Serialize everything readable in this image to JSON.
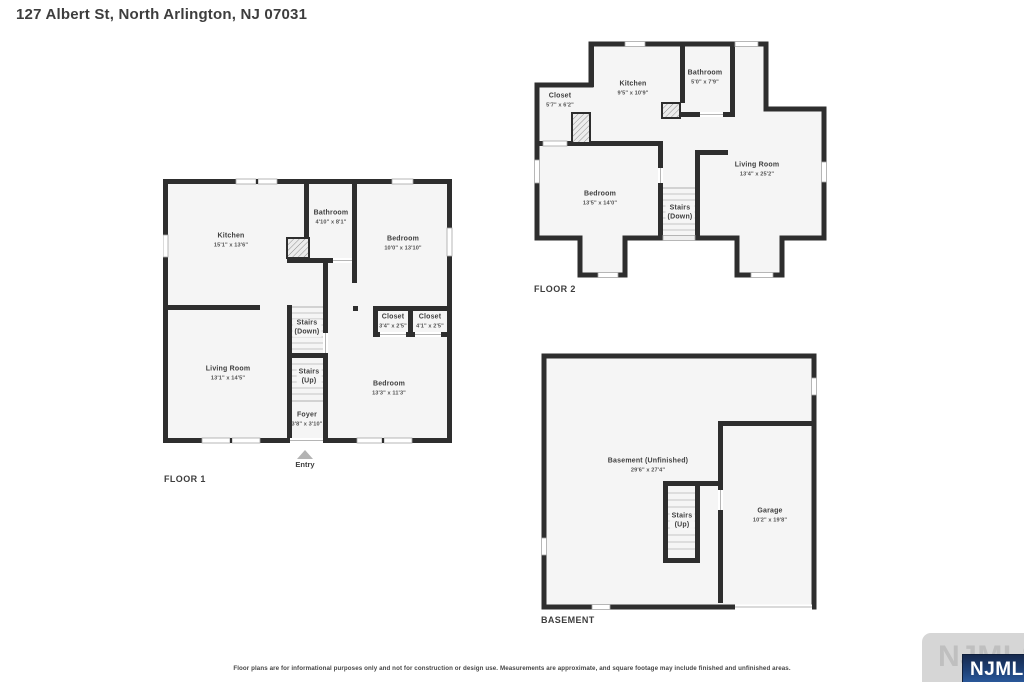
{
  "page": {
    "title": "127 Albert St, North Arlington, NJ 07031",
    "disclaimer": "Floor plans are for informational purposes only and not for construction or design use. Measurements are approximate, and square footage may include finished and unfinished areas."
  },
  "colors": {
    "wall": "#2e2e2e",
    "room_fill": "#f5f5f5",
    "window_frame": "#a6a6a6",
    "door_line": "#b5b5b5",
    "stair_tread": "#cfcfcf",
    "entry_arrow": "#b3b3b3",
    "badge_blue_top": "#16294e",
    "badge_blue_bottom": "#2f62a8",
    "plate_gray": "#d6d6d6"
  },
  "watermark": {
    "plate_label": "NJMLS",
    "badge_label": "NJMLS"
  },
  "floors": [
    {
      "label": "FLOOR 1",
      "entry_label": "Entry",
      "rooms": [
        {
          "name": "Kitchen",
          "dims": "15'1\" x 13'6\""
        },
        {
          "name": "Bathroom",
          "dims": "4'10\" x 8'1\""
        },
        {
          "name": "Bedroom",
          "dims": "10'0\" x 13'10\""
        },
        {
          "name": "Closet",
          "dims": "3'4\" x 2'5\""
        },
        {
          "name": "Closet",
          "dims": "4'1\" x 2'5\""
        },
        {
          "name": "Stairs",
          "sub": "(Down)"
        },
        {
          "name": "Stairs",
          "sub": "(Up)"
        },
        {
          "name": "Living Room",
          "dims": "13'1\" x 14'5\""
        },
        {
          "name": "Bedroom",
          "dims": "13'3\" x 11'3\""
        },
        {
          "name": "Foyer",
          "dims": "3'8\" x 3'10\""
        }
      ]
    },
    {
      "label": "FLOOR 2",
      "rooms": [
        {
          "name": "Closet",
          "dims": "5'7\" x 6'2\""
        },
        {
          "name": "Kitchen",
          "dims": "9'5\" x 10'9\""
        },
        {
          "name": "Bathroom",
          "dims": "5'0\" x 7'9\""
        },
        {
          "name": "Bedroom",
          "dims": "13'5\" x 14'0\""
        },
        {
          "name": "Living Room",
          "dims": "13'4\" x 25'2\""
        },
        {
          "name": "Stairs",
          "sub": "(Down)"
        }
      ]
    },
    {
      "label": "BASEMENT",
      "rooms": [
        {
          "name": "Basement (Unfinished)",
          "dims": "29'6\" x 27'4\""
        },
        {
          "name": "Stairs",
          "sub": "(Up)"
        },
        {
          "name": "Garage",
          "dims": "10'2\" x 19'8\""
        }
      ]
    }
  ]
}
